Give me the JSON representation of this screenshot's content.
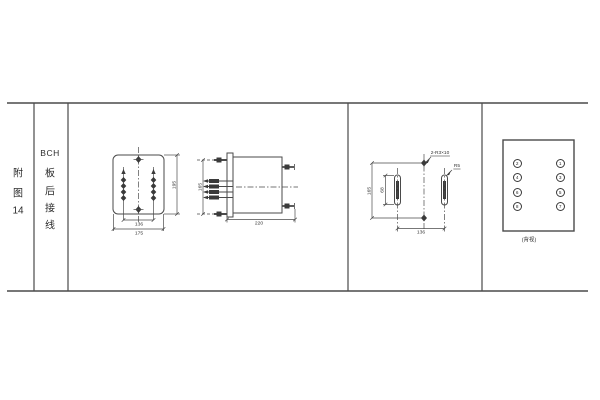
{
  "sidebar": {
    "figure": [
      "附",
      "图",
      "14"
    ],
    "category": [
      "BCH",
      "板",
      "后",
      "接",
      "线"
    ]
  },
  "front_view": {
    "inner_width": "136",
    "outer_width": "175",
    "height": "195"
  },
  "side_view": {
    "stud_spacing": "165",
    "depth": "220"
  },
  "drill_view": {
    "height": "165",
    "slot_length": "68",
    "width": "136",
    "holes_callout": "2-R3×10",
    "slot_callout": "R5"
  },
  "rear_view": {
    "left_terminals": [
      "2",
      "4",
      "6",
      "8"
    ],
    "right_terminals": [
      "1",
      "3",
      "5",
      "7"
    ],
    "caption": "(背视)"
  },
  "colors": {
    "line": "#4a4a4a",
    "text": "#333333",
    "background": "#ffffff"
  }
}
